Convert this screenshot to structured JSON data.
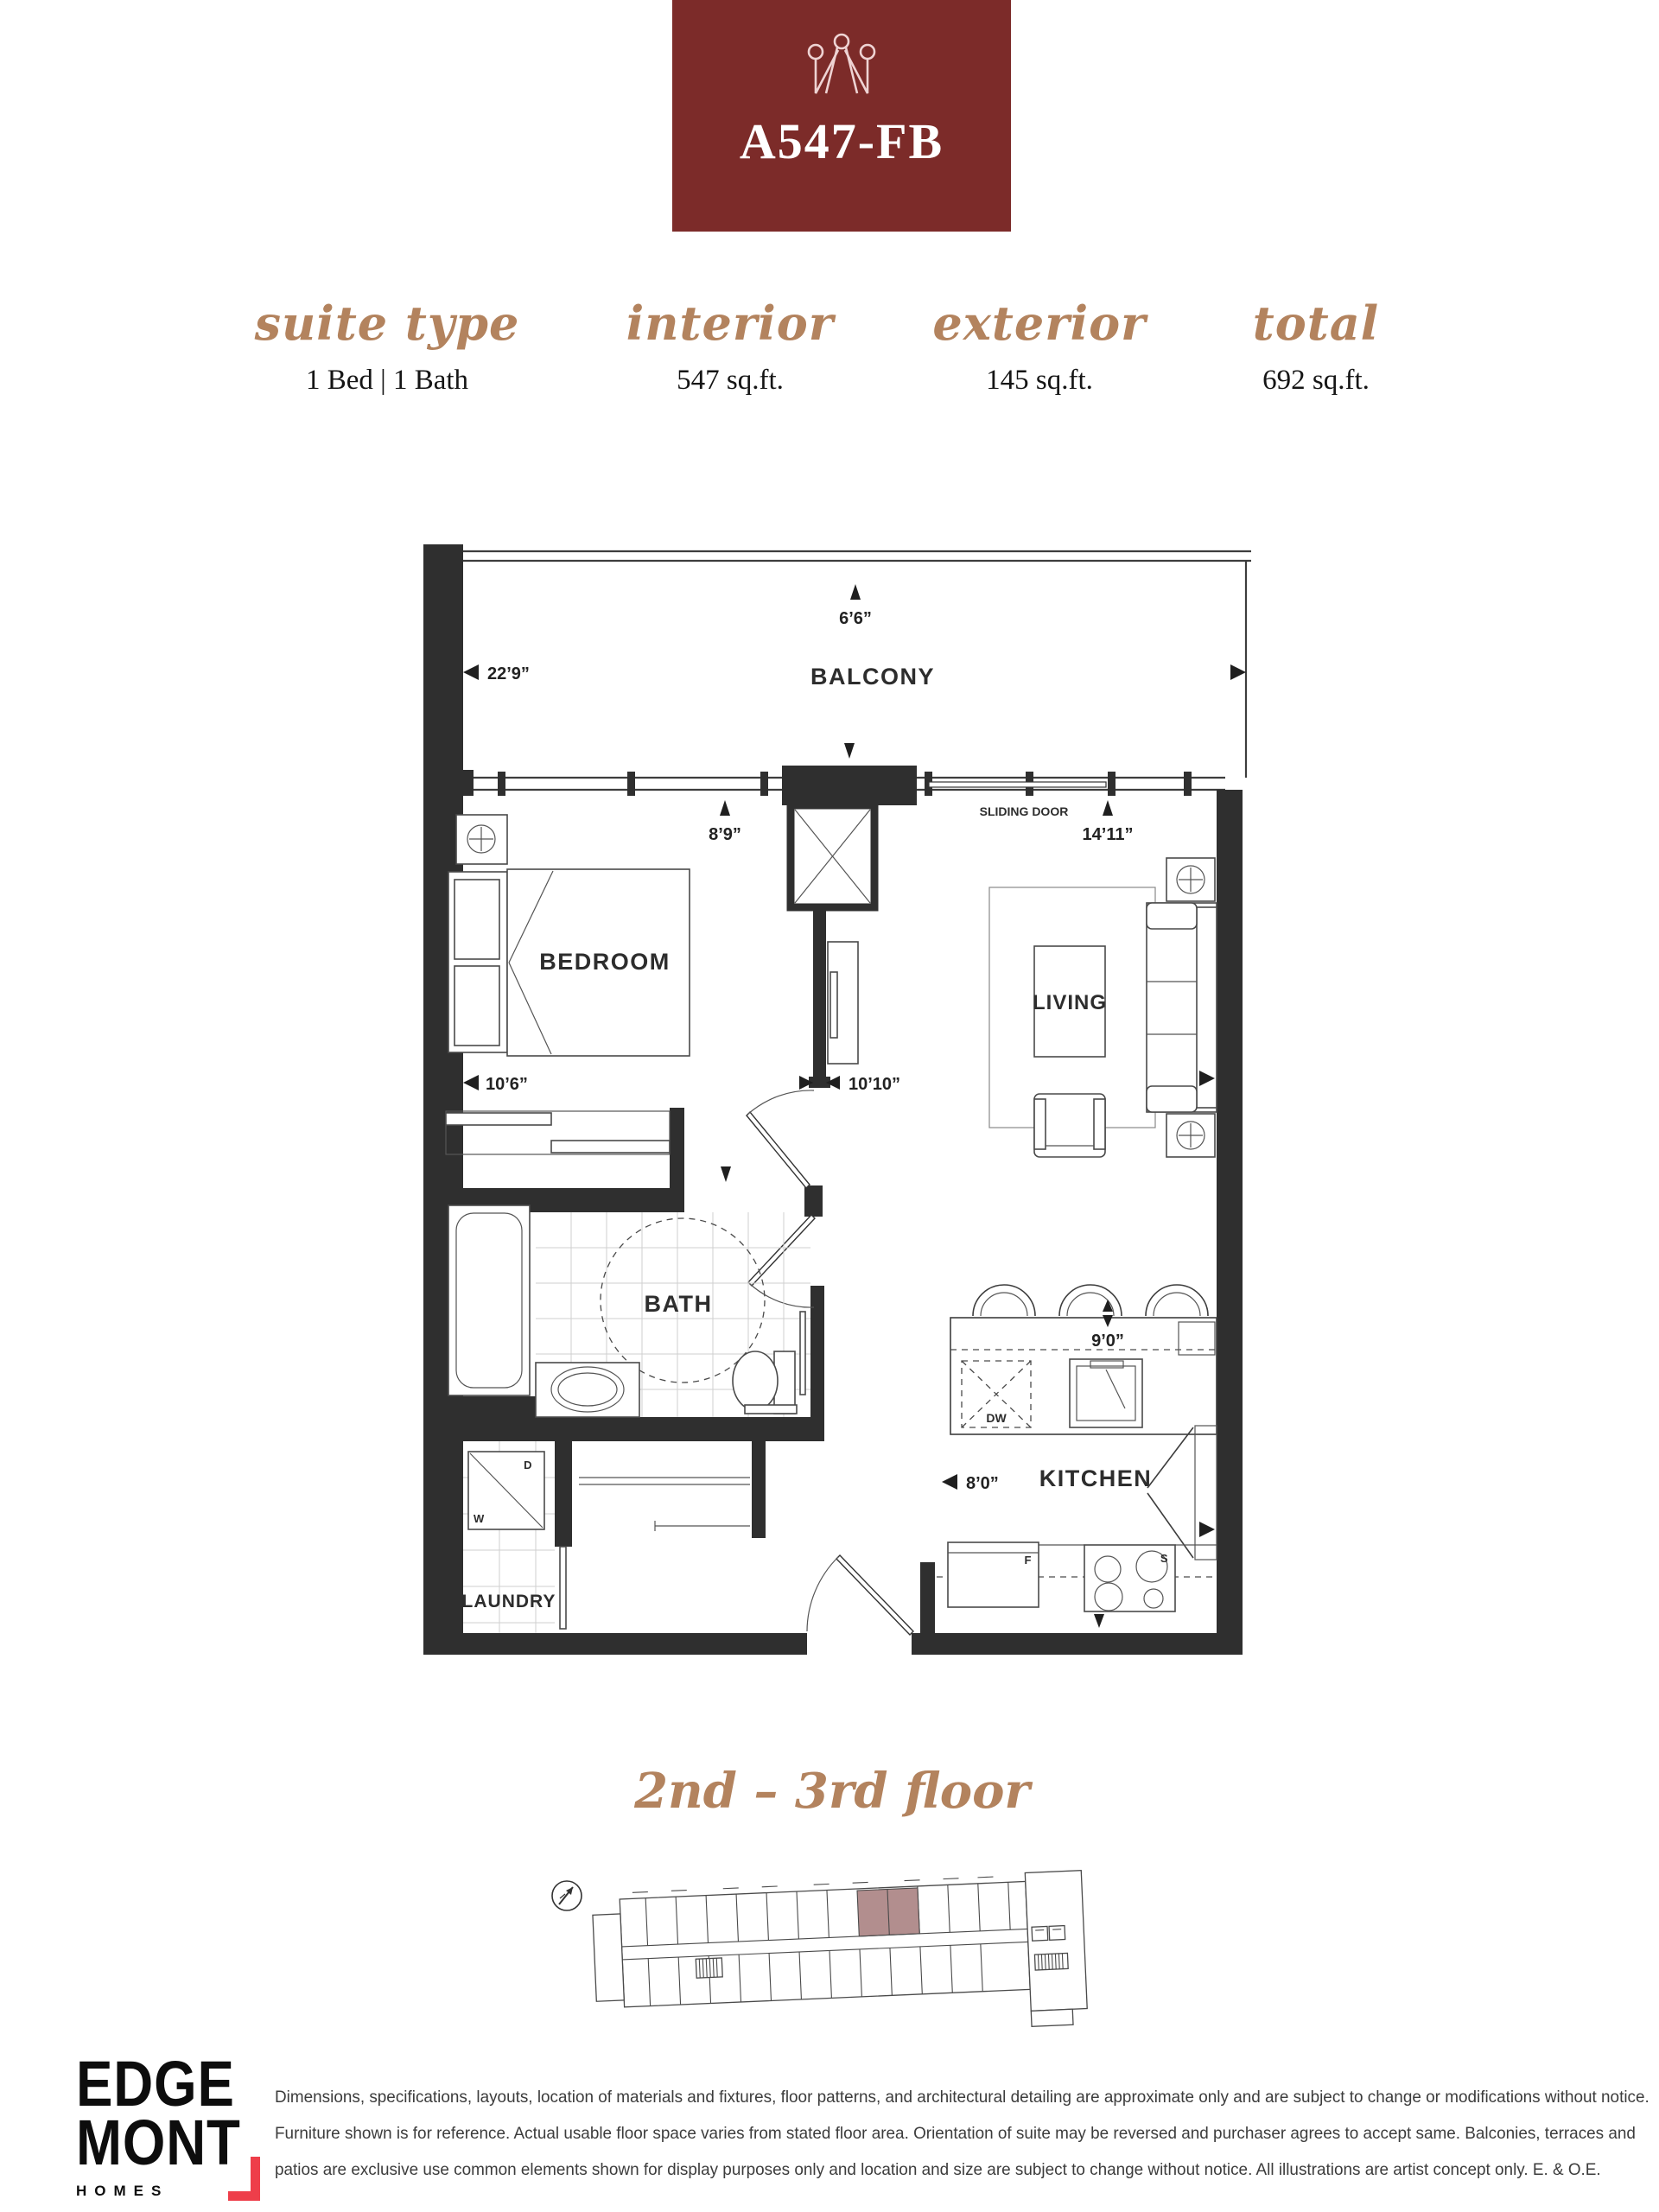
{
  "header": {
    "unit_code": "A547-FB",
    "box_color": "#7c2b29",
    "crown_color": "#eed3d3"
  },
  "stats": {
    "items": [
      {
        "label": "suite type",
        "value": "1 Bed  |  1 Bath"
      },
      {
        "label": "interior",
        "value": "547 sq.ft."
      },
      {
        "label": "exterior",
        "value": "145 sq.ft."
      },
      {
        "label": "total",
        "value": "692 sq.ft."
      }
    ]
  },
  "plan": {
    "rooms": {
      "balcony": "BALCONY",
      "bedroom": "BEDROOM",
      "living": "LIVING",
      "bath": "BATH",
      "kitchen": "KITCHEN",
      "laundry": "LAUNDRY"
    },
    "fixtures": {
      "sliding_door": "SLIDING DOOR",
      "dishwasher": "DW",
      "washer": "W",
      "dryer": "D",
      "fridge": "F",
      "stove": "S"
    },
    "dims": {
      "balcony_depth": "6’6”",
      "balcony_width": "22’9”",
      "bedroom_window": "8’9”",
      "living_window": "14’11”",
      "bedroom_width": "10’6”",
      "living_width": "10’10”",
      "kitchen_island": "9’0”",
      "kitchen_width": "8’0”"
    }
  },
  "keyplan": {
    "floor_label": "2nd – 3rd floor",
    "highlight_color": "#b28e8e"
  },
  "footer": {
    "logo": {
      "line1": "EDGE",
      "line2": "MONT",
      "line3": "HOMES",
      "accent": "#ee3e4a"
    },
    "disclaimer_lines": [
      "Dimensions, specifications, layouts, location of materials and fixtures, floor patterns, and architectural detailing are approximate only and are subject to change or modifications without notice.",
      "Furniture shown is for reference. Actual usable floor space varies from stated floor area. Orientation of suite may be reversed and purchaser agrees to accept same. Balconies, terraces and",
      "patios are exclusive use common elements shown for display purposes only and location and size are subject to change without notice. All illustrations are artist concept only. E. & O.E."
    ]
  }
}
